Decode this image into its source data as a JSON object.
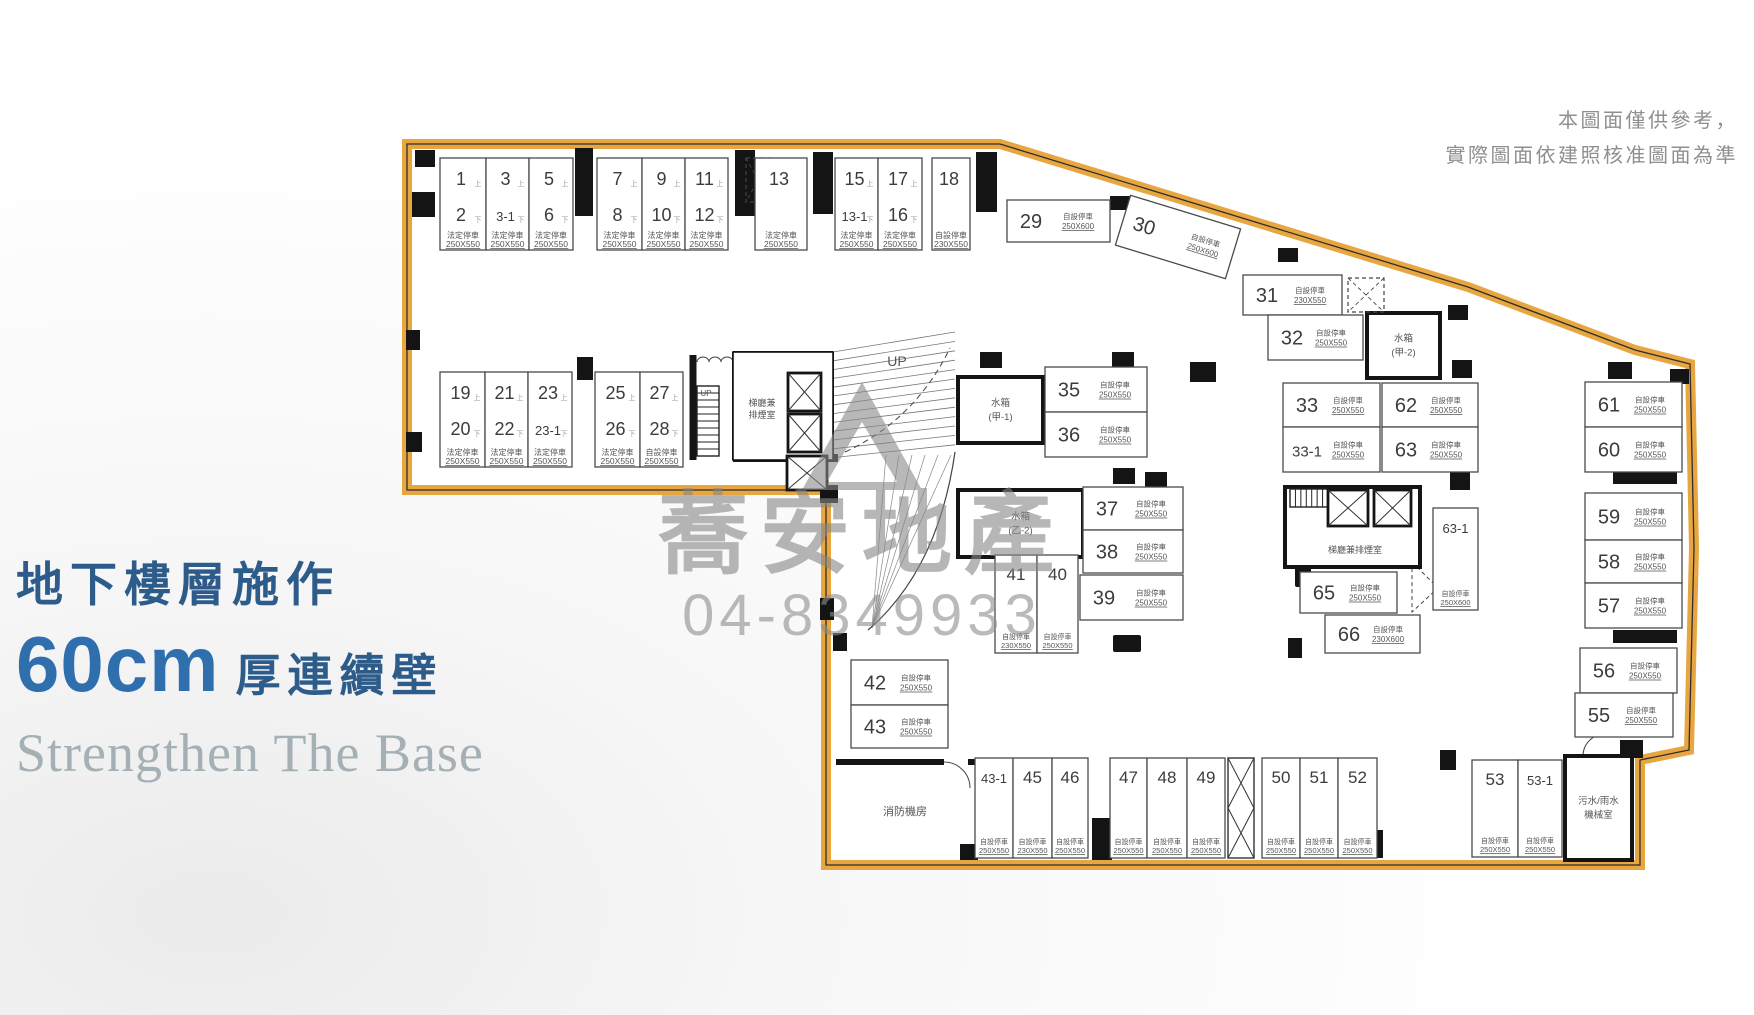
{
  "notice": {
    "line1": "本圖面僅供參考，",
    "line2": "實際圖面依建照核准圖面為準"
  },
  "headline": {
    "line1": "地下樓層施作",
    "big": "60cm",
    "line2": "厚連續壁",
    "english": "Strengthen The Base"
  },
  "watermark": {
    "brand": "蕎安地產",
    "phone": "04-8349933"
  },
  "colors": {
    "outline": "#E8A641",
    "wall": "#141414",
    "stall_border": "#4a4a4a",
    "number": "#3c3c3c",
    "label": "#555555",
    "mark": "#999999",
    "blue_dark": "#2d5c8b",
    "blue_bright": "#2f6fae",
    "gray_serif": "#a5b0b6",
    "notice_gray": "#8f8f8f",
    "watermark_gray": "#878787"
  },
  "plan": {
    "boundary": [
      [
        407,
        144
      ],
      [
        1000,
        144
      ],
      [
        1468,
        287
      ],
      [
        1635,
        350
      ],
      [
        1690,
        364
      ],
      [
        1694,
        548
      ],
      [
        1689,
        750
      ],
      [
        1640,
        760
      ],
      [
        1640,
        865
      ],
      [
        826,
        865
      ],
      [
        826,
        490
      ],
      [
        407,
        490
      ]
    ],
    "defaults": {
      "type": "自設停車",
      "size": "250X550"
    },
    "pair_stalls": [
      {
        "x": 440,
        "y": 158,
        "w": 46,
        "h": 92,
        "top": "1",
        "bot": "2",
        "type": "法定停車"
      },
      {
        "x": 486,
        "y": 158,
        "w": 43,
        "h": 92,
        "top": "3",
        "bot": "3-1",
        "type": "法定停車"
      },
      {
        "x": 529,
        "y": 158,
        "w": 44,
        "h": 92,
        "top": "5",
        "bot": "6",
        "type": "法定停車"
      },
      {
        "x": 597,
        "y": 158,
        "w": 45,
        "h": 92,
        "top": "7",
        "bot": "8",
        "type": "法定停車"
      },
      {
        "x": 642,
        "y": 158,
        "w": 43,
        "h": 92,
        "top": "9",
        "bot": "10",
        "type": "法定停車"
      },
      {
        "x": 685,
        "y": 158,
        "w": 43,
        "h": 92,
        "top": "11",
        "bot": "12",
        "type": "法定停車"
      },
      {
        "x": 755,
        "y": 158,
        "w": 52,
        "h": 92,
        "top": "13",
        "bot": "",
        "type": "法定停車"
      },
      {
        "x": 835,
        "y": 158,
        "w": 43,
        "h": 92,
        "top": "15",
        "bot": "13-1",
        "type": "法定停車"
      },
      {
        "x": 878,
        "y": 158,
        "w": 44,
        "h": 92,
        "top": "17",
        "bot": "16",
        "type": "法定停車"
      },
      {
        "x": 932,
        "y": 158,
        "w": 38,
        "h": 92,
        "top": "18",
        "bot": "",
        "type": "自設停車",
        "size": "230X550"
      },
      {
        "x": 440,
        "y": 372,
        "w": 45,
        "h": 95,
        "top": "19",
        "bot": "20",
        "type": "法定停車"
      },
      {
        "x": 485,
        "y": 372,
        "w": 43,
        "h": 95,
        "top": "21",
        "bot": "22",
        "type": "法定停車"
      },
      {
        "x": 528,
        "y": 372,
        "w": 44,
        "h": 95,
        "top": "23",
        "bot": "23-1",
        "type": "法定停車"
      },
      {
        "x": 595,
        "y": 372,
        "w": 45,
        "h": 95,
        "top": "25",
        "bot": "26",
        "type": "法定停車"
      },
      {
        "x": 640,
        "y": 372,
        "w": 43,
        "h": 95,
        "top": "27",
        "bot": "28",
        "type": "自設停車"
      }
    ],
    "h_stalls": [
      {
        "n": "29",
        "x": 1007,
        "y": 200,
        "w": 103,
        "h": 42,
        "size": "250X600"
      },
      {
        "n": "31",
        "x": 1243,
        "y": 275,
        "w": 99,
        "h": 40,
        "size": "230X550"
      },
      {
        "n": "32",
        "x": 1268,
        "y": 315,
        "w": 95,
        "h": 45
      },
      {
        "n": "33",
        "x": 1283,
        "y": 383,
        "w": 97,
        "h": 44
      },
      {
        "n": "62",
        "x": 1382,
        "y": 383,
        "w": 96,
        "h": 44
      },
      {
        "n": "33-1",
        "x": 1283,
        "y": 427,
        "w": 97,
        "h": 45
      },
      {
        "n": "63",
        "x": 1382,
        "y": 427,
        "w": 96,
        "h": 45
      },
      {
        "n": "35",
        "x": 1045,
        "y": 367,
        "w": 102,
        "h": 45
      },
      {
        "n": "36",
        "x": 1045,
        "y": 412,
        "w": 102,
        "h": 45
      },
      {
        "n": "37",
        "x": 1083,
        "y": 487,
        "w": 100,
        "h": 43
      },
      {
        "n": "38",
        "x": 1083,
        "y": 530,
        "w": 100,
        "h": 43
      },
      {
        "n": "39",
        "x": 1080,
        "y": 575,
        "w": 103,
        "h": 45
      },
      {
        "n": "42",
        "x": 851,
        "y": 660,
        "w": 97,
        "h": 45
      },
      {
        "n": "43",
        "x": 851,
        "y": 705,
        "w": 97,
        "h": 43
      },
      {
        "n": "65",
        "x": 1300,
        "y": 572,
        "w": 97,
        "h": 41
      },
      {
        "n": "66",
        "x": 1325,
        "y": 615,
        "w": 95,
        "h": 38,
        "size": "230X600"
      },
      {
        "n": "61",
        "x": 1585,
        "y": 382,
        "w": 97,
        "h": 45
      },
      {
        "n": "60",
        "x": 1585,
        "y": 427,
        "w": 97,
        "h": 45
      },
      {
        "n": "59",
        "x": 1585,
        "y": 493,
        "w": 97,
        "h": 47
      },
      {
        "n": "58",
        "x": 1585,
        "y": 540,
        "w": 97,
        "h": 43
      },
      {
        "n": "57",
        "x": 1585,
        "y": 583,
        "w": 97,
        "h": 45
      },
      {
        "n": "56",
        "x": 1580,
        "y": 648,
        "w": 97,
        "h": 45
      },
      {
        "n": "55",
        "x": 1575,
        "y": 693,
        "w": 98,
        "h": 44
      }
    ],
    "v_stalls": [
      {
        "n": "41",
        "x": 995,
        "y": 555,
        "w": 42,
        "h": 98,
        "size": "230X550"
      },
      {
        "n": "40",
        "x": 1037,
        "y": 555,
        "w": 41,
        "h": 98
      },
      {
        "n": "63-1",
        "x": 1433,
        "y": 508,
        "w": 45,
        "h": 102,
        "size": "250X600"
      },
      {
        "n": "43-1",
        "x": 975,
        "y": 758,
        "w": 38,
        "h": 100
      },
      {
        "n": "45",
        "x": 1013,
        "y": 758,
        "w": 39,
        "h": 100,
        "size": "230X550"
      },
      {
        "n": "46",
        "x": 1052,
        "y": 758,
        "w": 36,
        "h": 100
      },
      {
        "n": "47",
        "x": 1110,
        "y": 758,
        "w": 37,
        "h": 100
      },
      {
        "n": "48",
        "x": 1147,
        "y": 758,
        "w": 40,
        "h": 100
      },
      {
        "n": "49",
        "x": 1187,
        "y": 758,
        "w": 38,
        "h": 100
      },
      {
        "n": "50",
        "x": 1262,
        "y": 758,
        "w": 38,
        "h": 100
      },
      {
        "n": "51",
        "x": 1300,
        "y": 758,
        "w": 38,
        "h": 100
      },
      {
        "n": "52",
        "x": 1338,
        "y": 758,
        "w": 39,
        "h": 100
      },
      {
        "n": "53",
        "x": 1472,
        "y": 760,
        "w": 46,
        "h": 97
      },
      {
        "n": "53-1",
        "x": 1518,
        "y": 760,
        "w": 44,
        "h": 97
      }
    ],
    "rot_stalls": [
      {
        "n": "30",
        "cx": 1178,
        "cy": 237,
        "w": 115,
        "h": 52,
        "a": 17,
        "size": "250X600"
      }
    ],
    "rooms": [
      {
        "label": [
          "水箱",
          "(甲-1)"
        ],
        "x": 958,
        "y": 377,
        "w": 85,
        "h": 66,
        "bold": true
      },
      {
        "label": [
          "水箱",
          "(乙-2)"
        ],
        "x": 958,
        "y": 490,
        "w": 125,
        "h": 67,
        "bold": true
      },
      {
        "label": [
          "水箱",
          "(甲-2)"
        ],
        "x": 1367,
        "y": 313,
        "w": 73,
        "h": 65,
        "bold": true
      },
      {
        "label": [
          "污水/雨水",
          "機械室"
        ],
        "x": 1565,
        "y": 756,
        "w": 67,
        "h": 104,
        "bold": true
      },
      {
        "label": [],
        "x": 1285,
        "y": 487,
        "w": 135,
        "h": 80,
        "bold": true
      },
      {
        "label": [],
        "x": 733,
        "y": 352,
        "w": 100,
        "h": 108,
        "bold": false
      }
    ],
    "floor_labels": [
      {
        "t": "梯廳兼",
        "x": 762,
        "y": 406,
        "s": 9
      },
      {
        "t": "排煙室",
        "x": 762,
        "y": 418,
        "s": 9
      },
      {
        "t": "梯廳兼排煙室",
        "x": 1355,
        "y": 553,
        "s": 9
      },
      {
        "t": "消防機房",
        "x": 905,
        "y": 815,
        "s": 11
      },
      {
        "t": "UP",
        "x": 897,
        "y": 366,
        "s": 14
      },
      {
        "t": "UP",
        "x": 706,
        "y": 396,
        "s": 8
      }
    ],
    "pillars": [
      [
        415,
        150,
        20,
        17
      ],
      [
        412,
        192,
        23,
        25
      ],
      [
        406,
        330,
        14,
        20
      ],
      [
        406,
        432,
        16,
        20
      ],
      [
        575,
        148,
        18,
        68
      ],
      [
        735,
        150,
        20,
        66
      ],
      [
        813,
        152,
        20,
        62
      ],
      [
        976,
        152,
        21,
        60
      ],
      [
        897,
        197,
        18,
        20
      ],
      [
        1110,
        196,
        20,
        14
      ],
      [
        1278,
        248,
        20,
        14
      ],
      [
        1448,
        305,
        20,
        15
      ],
      [
        1190,
        362,
        26,
        20
      ],
      [
        1452,
        360,
        20,
        18
      ],
      [
        1145,
        472,
        22,
        18
      ],
      [
        1450,
        472,
        20,
        18
      ],
      [
        1112,
        352,
        22,
        16
      ],
      [
        1113,
        468,
        22,
        16
      ],
      [
        980,
        352,
        22,
        16
      ],
      [
        1608,
        362,
        24,
        17
      ],
      [
        1670,
        369,
        19,
        15
      ],
      [
        1613,
        472,
        64,
        12
      ],
      [
        1613,
        630,
        64,
        13
      ],
      [
        1620,
        740,
        23,
        18
      ],
      [
        1440,
        750,
        16,
        20
      ],
      [
        1092,
        818,
        20,
        42
      ],
      [
        1363,
        830,
        20,
        28
      ],
      [
        960,
        844,
        18,
        16
      ],
      [
        1288,
        638,
        14,
        20
      ],
      [
        820,
        485,
        18,
        18
      ],
      [
        820,
        598,
        14,
        22
      ],
      [
        833,
        633,
        14,
        18
      ],
      [
        577,
        357,
        16,
        23
      ]
    ],
    "walls": [
      [
        693,
        355,
        693,
        460,
        7
      ],
      [
        733,
        352,
        833,
        352,
        2
      ],
      [
        733,
        352,
        733,
        460,
        2
      ],
      [
        733,
        458,
        838,
        458,
        8
      ],
      [
        833,
        352,
        833,
        458,
        2
      ],
      [
        836,
        762,
        944,
        762,
        6
      ],
      [
        968,
        762,
        978,
        762,
        6
      ],
      [
        995,
        555,
        1078,
        555,
        1.5
      ]
    ],
    "paths": [
      {
        "d": "M697,362 a6,5 0 0 1 12,0 a6,5 0 0 1 12,0 a6,5 0 0 1 12,0",
        "w": 1
      },
      {
        "d": "M944,762 a26,26 0 0 1 26,26",
        "w": 1
      },
      {
        "d": "M955,452 Q938,570 868,630",
        "w": 1.2
      },
      {
        "d": "M845,452 Q915,420 950,348",
        "w": 1,
        "dash": "6,4"
      },
      {
        "d": "M1292,522 a30,30 0 0 0 22,34",
        "w": 1
      },
      {
        "d": "M1412,562 L1438,588 L1412,612 Z",
        "w": 1,
        "dash": "4,3"
      },
      {
        "d": "M1583,756 a22,22 0 0 1 22,-22",
        "w": 1
      }
    ],
    "elevators": [
      [
        788,
        373,
        33,
        38
      ],
      [
        788,
        414,
        33,
        38
      ],
      [
        787,
        456,
        40,
        34
      ],
      [
        1328,
        490,
        40,
        36
      ],
      [
        1374,
        490,
        37,
        36
      ]
    ],
    "stairs": [
      {
        "x": 697,
        "y": 386,
        "w": 22,
        "h": 70,
        "steps": 10,
        "dir": "v"
      },
      {
        "x": 1290,
        "y": 489,
        "w": 38,
        "h": 18,
        "steps": 7,
        "dir": "h"
      }
    ],
    "dashed_boxes": [
      [
        746,
        158,
        24,
        44
      ],
      [
        1348,
        278,
        36,
        34
      ]
    ],
    "braces": [
      [
        1228,
        758,
        26,
        100
      ]
    ],
    "icons": [
      [
        1295,
        565,
        16,
        22
      ],
      [
        1113,
        635,
        28,
        17
      ]
    ],
    "ramp": {
      "x1": 833,
      "x2": 955,
      "y1": 352,
      "y2": 332,
      "n": 13,
      "d1": 8.8,
      "d2": 9.4
    },
    "marks": {
      "up": "上",
      "down": "下"
    }
  }
}
